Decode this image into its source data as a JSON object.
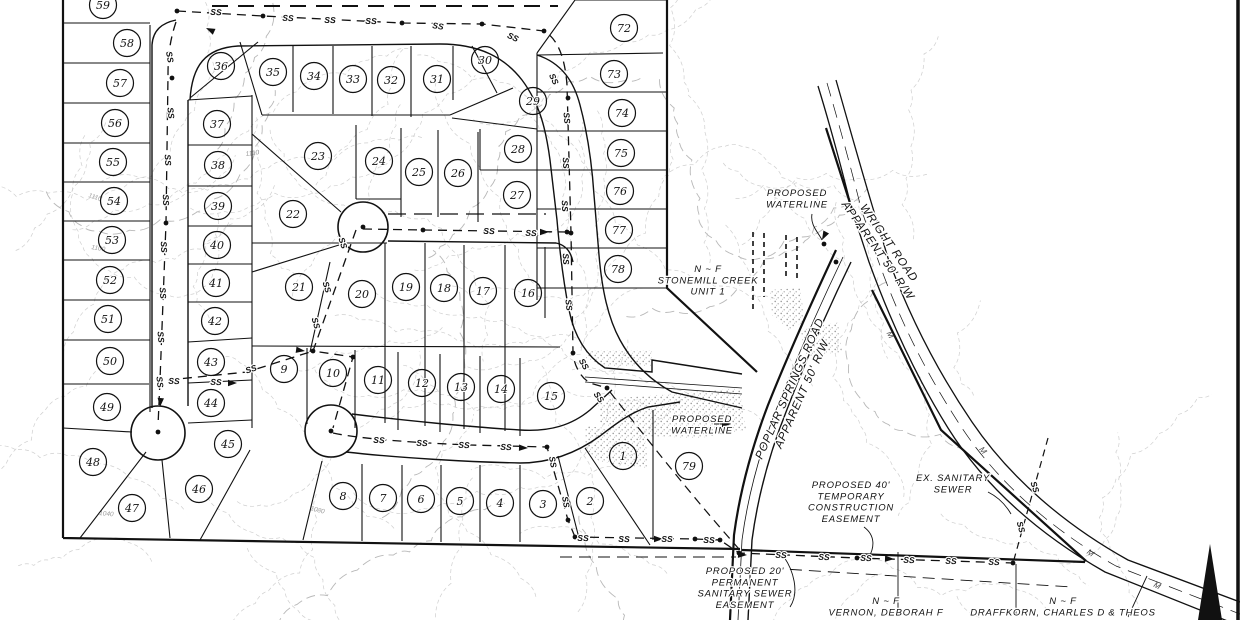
{
  "drawing": {
    "kind": "subdivision-plat-map",
    "sewer_label": "SS",
    "marker_label": "M",
    "lots": [
      [
        1,
        623,
        456
      ],
      [
        2,
        590,
        501
      ],
      [
        3,
        543,
        504
      ],
      [
        4,
        500,
        503
      ],
      [
        5,
        460,
        501
      ],
      [
        6,
        421,
        499
      ],
      [
        7,
        383,
        498
      ],
      [
        8,
        343,
        496
      ],
      [
        9,
        284,
        369
      ],
      [
        10,
        333,
        373
      ],
      [
        11,
        378,
        380
      ],
      [
        12,
        422,
        383
      ],
      [
        13,
        461,
        387
      ],
      [
        14,
        501,
        389
      ],
      [
        15,
        551,
        396
      ],
      [
        16,
        528,
        293
      ],
      [
        17,
        483,
        291
      ],
      [
        18,
        444,
        288
      ],
      [
        19,
        406,
        287
      ],
      [
        20,
        362,
        294
      ],
      [
        21,
        299,
        287
      ],
      [
        22,
        293,
        214
      ],
      [
        23,
        318,
        156
      ],
      [
        24,
        379,
        161
      ],
      [
        25,
        419,
        172
      ],
      [
        26,
        458,
        173
      ],
      [
        27,
        517,
        195
      ],
      [
        28,
        518,
        149
      ],
      [
        29,
        533,
        101
      ],
      [
        30,
        485,
        60
      ],
      [
        31,
        437,
        79
      ],
      [
        32,
        391,
        80
      ],
      [
        33,
        353,
        79
      ],
      [
        34,
        314,
        76
      ],
      [
        35,
        273,
        72
      ],
      [
        36,
        221,
        66
      ],
      [
        37,
        217,
        124
      ],
      [
        38,
        218,
        165
      ],
      [
        39,
        218,
        206
      ],
      [
        40,
        217,
        245
      ],
      [
        41,
        216,
        283
      ],
      [
        42,
        215,
        321
      ],
      [
        43,
        211,
        362
      ],
      [
        44,
        211,
        403
      ],
      [
        45,
        228,
        444
      ],
      [
        46,
        199,
        489
      ],
      [
        47,
        132,
        508
      ],
      [
        48,
        93,
        462
      ],
      [
        49,
        107,
        407
      ],
      [
        50,
        110,
        361
      ],
      [
        51,
        108,
        319
      ],
      [
        52,
        110,
        280
      ],
      [
        53,
        112,
        240
      ],
      [
        54,
        114,
        201
      ],
      [
        55,
        113,
        162
      ],
      [
        56,
        115,
        123
      ],
      [
        57,
        120,
        83
      ],
      [
        58,
        127,
        43
      ],
      [
        59,
        103,
        5
      ],
      [
        72,
        624,
        28
      ],
      [
        73,
        614,
        74
      ],
      [
        74,
        622,
        113
      ],
      [
        75,
        621,
        153
      ],
      [
        76,
        620,
        191
      ],
      [
        77,
        619,
        230
      ],
      [
        78,
        618,
        269
      ],
      [
        79,
        689,
        466
      ]
    ],
    "ss_labels": [
      [
        216,
        12,
        3
      ],
      [
        288,
        18,
        2
      ],
      [
        330,
        20,
        1
      ],
      [
        371,
        21,
        1
      ],
      [
        438,
        26,
        8
      ],
      [
        513,
        37,
        25
      ],
      [
        554,
        79,
        65
      ],
      [
        567,
        118,
        85
      ],
      [
        566,
        163,
        87
      ],
      [
        565,
        206,
        88
      ],
      [
        566,
        259,
        87
      ],
      [
        569,
        305,
        84
      ],
      [
        584,
        364,
        60
      ],
      [
        599,
        397,
        55
      ],
      [
        170,
        57,
        80
      ],
      [
        171,
        113,
        84
      ],
      [
        168,
        160,
        86
      ],
      [
        166,
        200,
        87
      ],
      [
        164,
        247,
        87
      ],
      [
        163,
        293,
        86
      ],
      [
        161,
        337,
        85
      ],
      [
        160,
        382,
        83
      ],
      [
        174,
        381,
        2
      ],
      [
        216,
        382,
        2
      ],
      [
        251,
        369,
        -18
      ],
      [
        343,
        243,
        72
      ],
      [
        327,
        287,
        73
      ],
      [
        316,
        323,
        74
      ],
      [
        489,
        231,
        1
      ],
      [
        531,
        233,
        2
      ],
      [
        379,
        440,
        3
      ],
      [
        422,
        443,
        2
      ],
      [
        464,
        445,
        2
      ],
      [
        506,
        447,
        2
      ],
      [
        553,
        462,
        80
      ],
      [
        566,
        502,
        80
      ],
      [
        583,
        538,
        1
      ],
      [
        624,
        539,
        1
      ],
      [
        667,
        539,
        0
      ],
      [
        709,
        540,
        1
      ],
      [
        781,
        555,
        2
      ],
      [
        824,
        557,
        2
      ],
      [
        866,
        558,
        2
      ],
      [
        909,
        560,
        2
      ],
      [
        951,
        561,
        2
      ],
      [
        994,
        562,
        2
      ],
      [
        1035,
        487,
        72
      ],
      [
        1021,
        527,
        75
      ]
    ],
    "m_markers": [
      [
        888,
        336,
        62
      ],
      [
        981,
        452,
        50
      ],
      [
        1089,
        555,
        35
      ],
      [
        1156,
        588,
        28
      ]
    ],
    "annotations": [
      {
        "id": "waterline-upper",
        "lines": [
          "PROPOSED",
          "WATERLINE"
        ],
        "x": 797,
        "y": 196,
        "rot": 0,
        "size": 9.5
      },
      {
        "id": "wright-road",
        "lines": [
          "WRIGHT ROAD",
          "APPARENT 50' R/W"
        ],
        "x": 886,
        "y": 245,
        "rot": 55,
        "size": 11.5
      },
      {
        "id": "poplar-road",
        "lines": [
          "POPLAR SPRINGS ROAD",
          "APPARENT 50' R/W"
        ],
        "x": 793,
        "y": 390,
        "rot": -66,
        "size": 11.5
      },
      {
        "id": "stonemill",
        "lines": [
          "N ~ F",
          "STONEMILL CREEK",
          "UNIT 1"
        ],
        "x": 708,
        "y": 272,
        "rot": 0,
        "size": 9.5
      },
      {
        "id": "waterline-lower",
        "lines": [
          "PROPOSED",
          "WATERLINE"
        ],
        "x": 702,
        "y": 422,
        "rot": 0,
        "size": 9.5
      },
      {
        "id": "ex-sewer",
        "lines": [
          "EX. SANITARY",
          "SEWER"
        ],
        "x": 953,
        "y": 481,
        "rot": 0,
        "size": 9.5
      },
      {
        "id": "temp-easement",
        "lines": [
          "PROPOSED 40'",
          "TEMPORARY",
          "CONSTRUCTION",
          "EASEMENT"
        ],
        "x": 851,
        "y": 488,
        "rot": 0,
        "size": 9.5
      },
      {
        "id": "perm-easement",
        "lines": [
          "PROPOSED 20'",
          "PERMANENT",
          "SANITARY SEWER",
          "EASEMENT"
        ],
        "x": 745,
        "y": 574,
        "rot": 0,
        "size": 9.5
      },
      {
        "id": "vernon",
        "lines": [
          "N ~ F",
          "VERNON, DEBORAH F"
        ],
        "x": 886,
        "y": 604,
        "rot": 0,
        "size": 9.5
      },
      {
        "id": "draffkorn",
        "lines": [
          "N ~ F",
          "DRAFFKORN, CHARLES D & THEOS"
        ],
        "x": 1063,
        "y": 604,
        "rot": 0,
        "size": 9.5
      }
    ],
    "contour_labels": [
      {
        "v": "1110",
        "x": 246,
        "y": 156,
        "r": -8
      },
      {
        "v": "1110",
        "x": 88,
        "y": 197,
        "r": 18
      },
      {
        "v": "1100",
        "x": 91,
        "y": 249,
        "r": 10
      },
      {
        "v": "1040",
        "x": 99,
        "y": 515,
        "r": 5
      },
      {
        "v": "1080",
        "x": 310,
        "y": 510,
        "r": 15
      }
    ],
    "colors": {
      "ink": "#111111",
      "contour": "#cfcfcf",
      "contour_index": "#b8b8b8",
      "road_gray": "#8a8a8a",
      "stipple": "#a0a0a0"
    }
  }
}
